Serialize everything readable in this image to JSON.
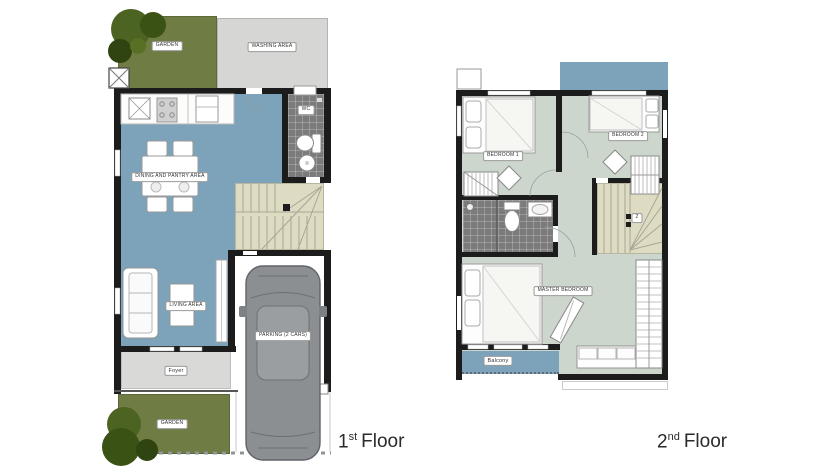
{
  "floor1": {
    "title": {
      "number": "1",
      "ordinal": "st",
      "word": "Floor"
    },
    "labels": {
      "garden_top": "GARDEN",
      "washing_area": "WASHING AREA",
      "dining": "DINING AND PANTRY AREA",
      "wc": "WC",
      "living": "LIVING AREA",
      "foyer": "Foyer",
      "parking": "PARKING (2 CARS)",
      "garden_bottom": "GARDEN"
    }
  },
  "floor2": {
    "title": {
      "number": "2",
      "ordinal": "nd",
      "word": "Floor"
    },
    "labels": {
      "bedroom1": "BEDROOM 1",
      "bedroom2": "BEDROOM 2",
      "stair_floor_marker": "2",
      "master_bedroom": "MASTER BEDROOM",
      "balcony": "Balcony"
    }
  },
  "colors": {
    "wall": "#1c1c1c",
    "floor_blue": "#7ca3ba",
    "floor_sage": "#cdd6cc",
    "garden_olive": "#6f7d44",
    "tree_green": "#44591d",
    "stair_beige": "#dedbc3",
    "bath_tile_gray": "#7b7b7b",
    "washing_gray": "#d6d6d4",
    "foyer_gray": "#d9d9d7",
    "car_gray": "#8b8f92"
  }
}
